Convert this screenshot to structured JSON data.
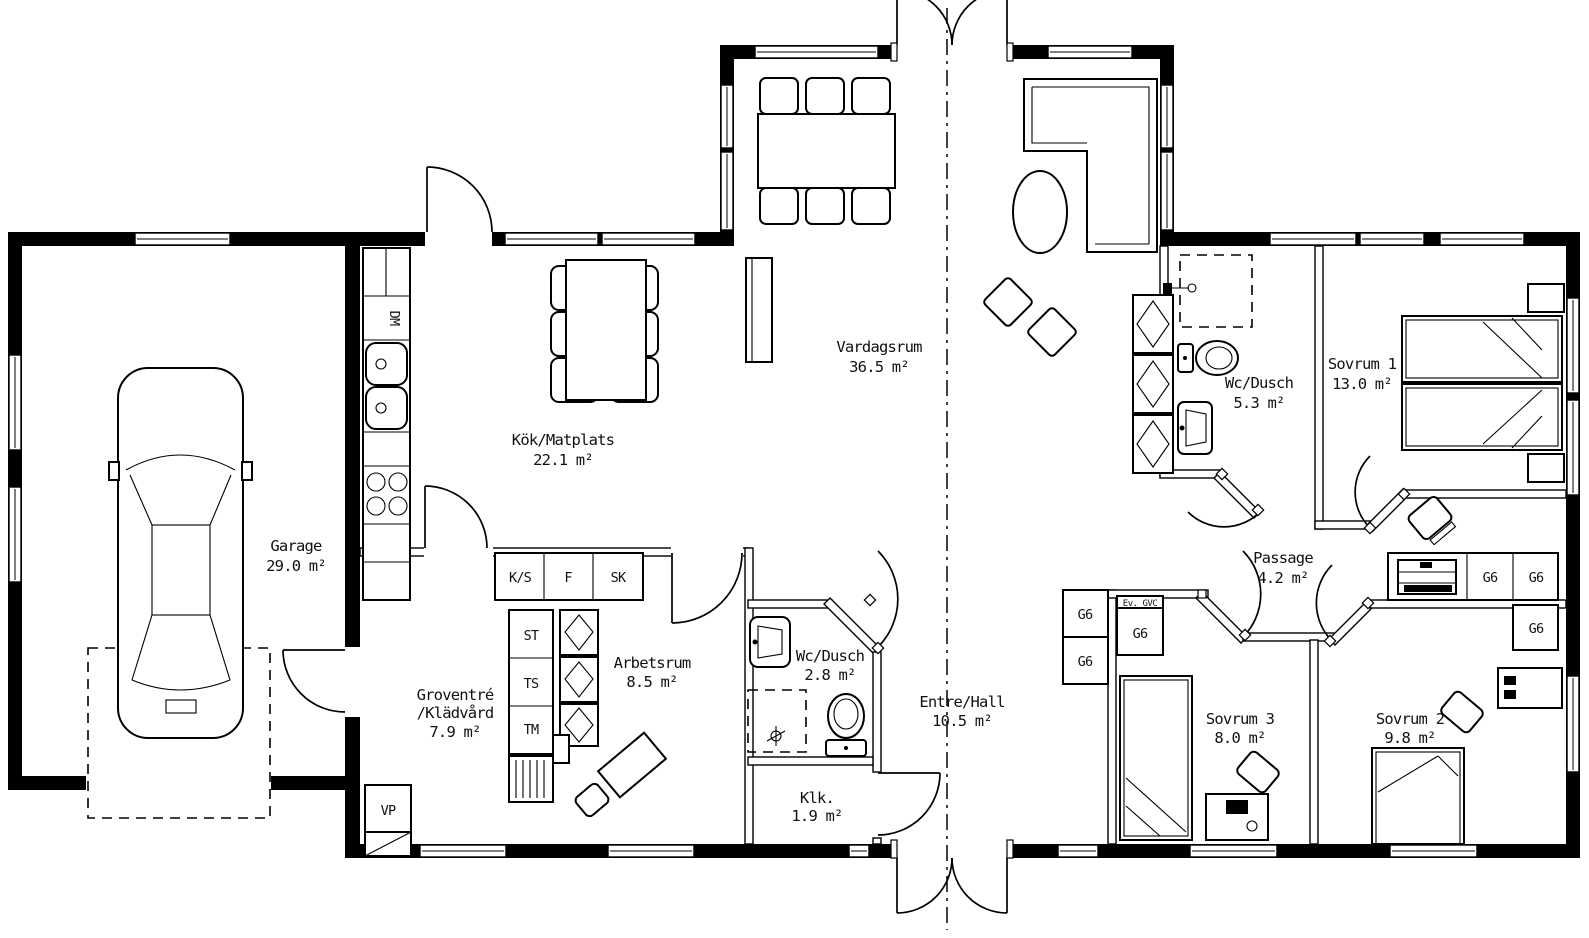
{
  "rooms": {
    "garage": {
      "name": "Garage",
      "area": "29.0 m²"
    },
    "kok": {
      "name": "Kök/Matplats",
      "area": "22.1 m²"
    },
    "vardagsrum": {
      "name": "Vardagsrum",
      "area": "36.5 m²"
    },
    "wc_dusch_1": {
      "name": "Wc/Dusch",
      "area": "5.3 m²"
    },
    "sovrum1": {
      "name": "Sovrum 1",
      "area": "13.0 m²"
    },
    "passage": {
      "name": "Passage",
      "area": "4.2 m²"
    },
    "groventre": {
      "line1": "Groventré",
      "line2": "/Klädvård",
      "area": "7.9 m²"
    },
    "arbetsrum": {
      "name": "Arbetsrum",
      "area": "8.5 m²"
    },
    "wc_dusch_2": {
      "name": "Wc/Dusch",
      "area": "2.8 m²"
    },
    "entre_hall": {
      "name": "Entre/Hall",
      "area": "10.5 m²"
    },
    "klk": {
      "name": "Klk.",
      "area": "1.9 m²"
    },
    "sovrum3": {
      "name": "Sovrum 3",
      "area": "8.0 m²"
    },
    "sovrum2": {
      "name": "Sovrum 2",
      "area": "9.8 m²"
    }
  },
  "fixtures": {
    "dm": "DM",
    "ks": "K/S",
    "f": "F",
    "sk": "SK",
    "st": "ST",
    "ts": "TS",
    "tm": "TM",
    "vp": "VP",
    "g6": "G6",
    "ev_gvc": "Ev. GVC"
  },
  "colors": {
    "ink": "#000000",
    "paper": "#ffffff"
  }
}
